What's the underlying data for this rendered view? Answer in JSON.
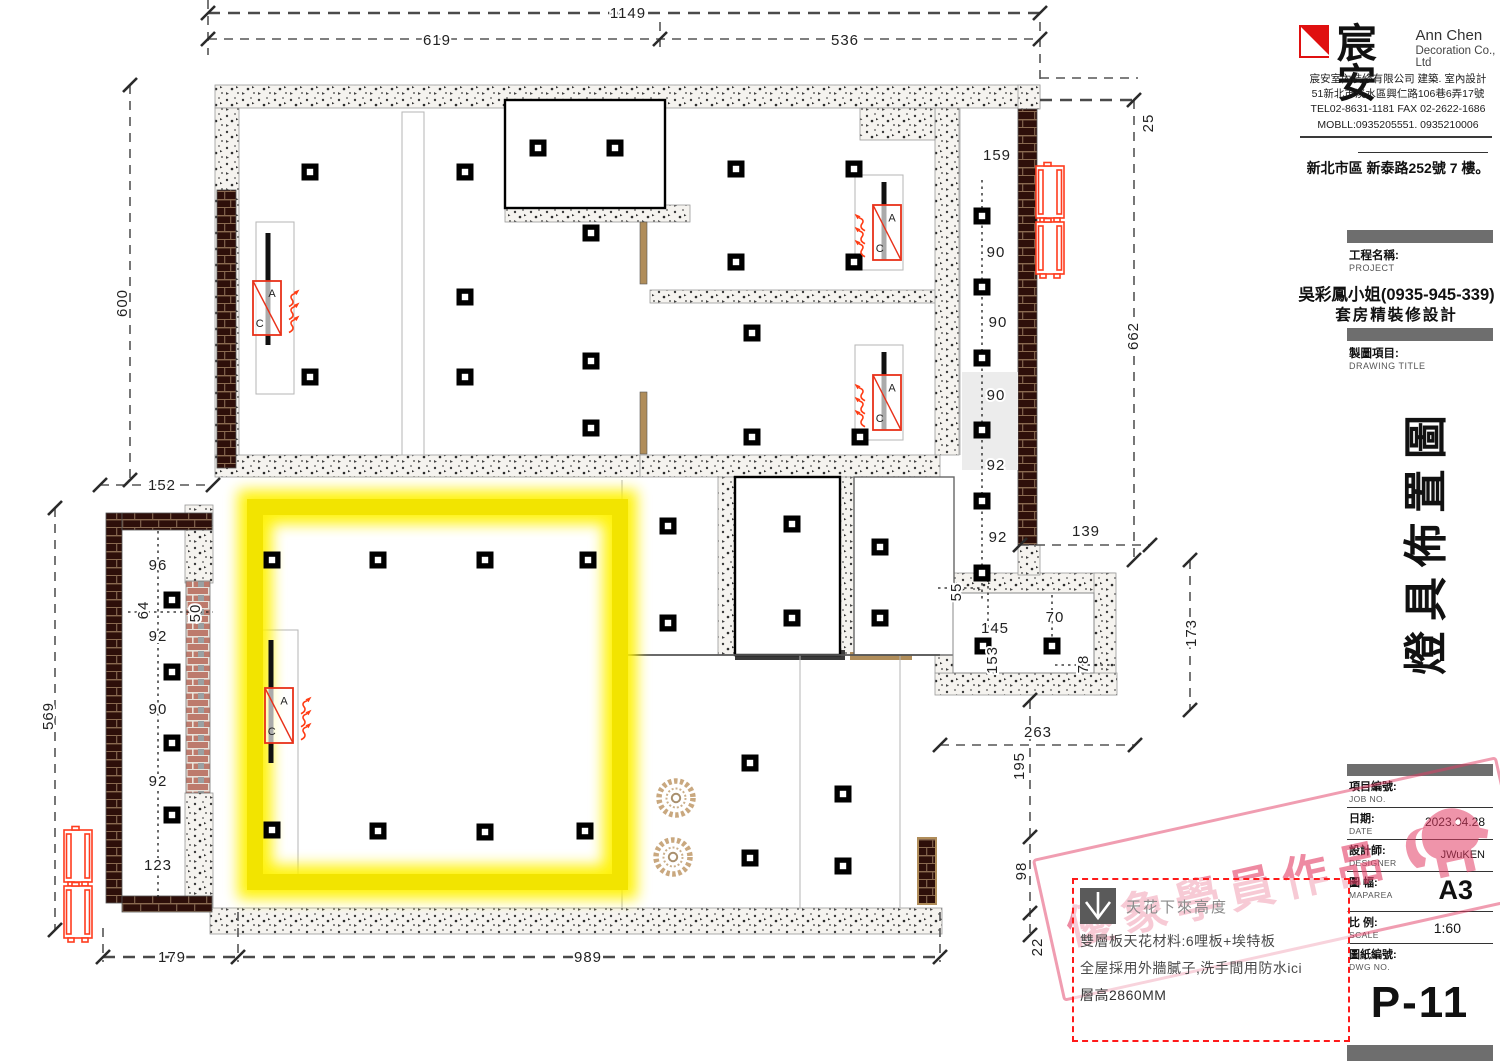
{
  "title_block": {
    "logo_cn": "宸安",
    "logo_en_line1": "Ann Chen",
    "logo_en_line2": "Decoration Co., Ltd",
    "company_line": "宸安室內裝修有限公司 建築. 室內設計",
    "company_address": "51新北市淡水區興仁路106巷6弄17號",
    "company_tel": "TEL02-8631-1181 FAX 02-2622-1686",
    "company_mobile": "MOBLL:0935205551. 0935210006",
    "site_address": "新北市區 新泰路252號 7 樓。",
    "project_label_cn": "工程名稱:",
    "project_label_en": "PROJECT",
    "client_name": "吳彩鳳小姐(0935-945-339)",
    "project_name": "套房精裝修設計",
    "drawing_label_cn": "製圖項目:",
    "drawing_label_en": "DRAWING TITLE",
    "drawing_title_vertical": "燈具佈置圖",
    "fields": {
      "job_label_cn": "項目編號:",
      "job_label_en": "JOB NO.",
      "job_value": "",
      "date_label_cn": "日期:",
      "date_label_en": "DATE",
      "date_value": "2023.04.28",
      "designer_label_cn": "設計師:",
      "designer_label_en": "DESIGNER",
      "designer_value": "JWuKEN",
      "map_label_cn": "圖 幅:",
      "map_label_en": "MAPAREA",
      "map_value": "A3",
      "scale_label_cn": "比 例:",
      "scale_label_en": "SCALE",
      "scale_value": "1:60",
      "dwg_label_cn": "圖紙編號:",
      "dwg_label_en": "DWG NO.",
      "dwg_value": "P-11"
    }
  },
  "note_box": {
    "icon_label": "天花下來高度",
    "line1": "雙層板天花材料:6哩板+埃特板",
    "line2": "全屋採用外牆膩子,洗手間用防水ici",
    "line3": "層高2860MM"
  },
  "watermark": {
    "text": "優象學員作品"
  },
  "colors": {
    "cove_yellow": "#f5e800",
    "ac_red": "#e8311a",
    "stamp_pink": "#e23c64",
    "dim_line": "#4a4a4a"
  },
  "plan": {
    "dim_labels": [
      {
        "t": "1149",
        "x": 628,
        "y": 18
      },
      {
        "t": "619",
        "x": 437,
        "y": 45
      },
      {
        "t": "536",
        "x": 845,
        "y": 45
      },
      {
        "t": "600",
        "x": 127,
        "y": 303,
        "r": 1
      },
      {
        "t": "152",
        "x": 162,
        "y": 490
      },
      {
        "t": "569",
        "x": 53,
        "y": 716,
        "r": 1
      },
      {
        "t": "179",
        "x": 172,
        "y": 962
      },
      {
        "t": "989",
        "x": 588,
        "y": 962
      },
      {
        "t": "25",
        "x": 1153,
        "y": 123,
        "r": 1
      },
      {
        "t": "662",
        "x": 1138,
        "y": 336,
        "r": 1
      },
      {
        "t": "139",
        "x": 1086,
        "y": 536
      },
      {
        "t": "173",
        "x": 1196,
        "y": 633,
        "r": 1
      },
      {
        "t": "263",
        "x": 1038,
        "y": 737
      },
      {
        "t": "195",
        "x": 1024,
        "y": 766,
        "r": 1
      },
      {
        "t": "98",
        "x": 1026,
        "y": 871,
        "r": 1
      },
      {
        "t": "22",
        "x": 1042,
        "y": 947,
        "r": 1
      },
      {
        "t": "159",
        "x": 997,
        "y": 160
      },
      {
        "t": "90",
        "x": 996,
        "y": 257
      },
      {
        "t": "90",
        "x": 998,
        "y": 327
      },
      {
        "t": "90",
        "x": 996,
        "y": 400
      },
      {
        "t": "92",
        "x": 996,
        "y": 470
      },
      {
        "t": "92",
        "x": 998,
        "y": 542
      },
      {
        "t": "55",
        "x": 961,
        "y": 592,
        "r": 1
      },
      {
        "t": "145",
        "x": 995,
        "y": 633
      },
      {
        "t": "153",
        "x": 997,
        "y": 660,
        "r": 1
      },
      {
        "t": "70",
        "x": 1055,
        "y": 622
      },
      {
        "t": "78",
        "x": 1088,
        "y": 664,
        "r": 1
      },
      {
        "t": "96",
        "x": 158,
        "y": 570
      },
      {
        "t": "64",
        "x": 148,
        "y": 610,
        "r": 1
      },
      {
        "t": "50",
        "x": 200,
        "y": 613,
        "r": 1
      },
      {
        "t": "92",
        "x": 158,
        "y": 641
      },
      {
        "t": "90",
        "x": 158,
        "y": 714
      },
      {
        "t": "92",
        "x": 158,
        "y": 786
      },
      {
        "t": "123",
        "x": 158,
        "y": 870
      }
    ],
    "lights": [
      [
        310,
        172
      ],
      [
        465,
        172
      ],
      [
        465,
        297
      ],
      [
        310,
        377
      ],
      [
        465,
        377
      ],
      [
        538,
        148
      ],
      [
        615,
        148
      ],
      [
        591,
        233
      ],
      [
        591,
        361
      ],
      [
        591,
        428
      ],
      [
        736,
        169
      ],
      [
        854,
        169
      ],
      [
        736,
        262
      ],
      [
        854,
        262
      ],
      [
        752,
        333
      ],
      [
        752,
        437
      ],
      [
        860,
        437
      ],
      [
        982,
        216
      ],
      [
        982,
        287
      ],
      [
        982,
        358
      ],
      [
        982,
        430
      ],
      [
        982,
        501
      ],
      [
        982,
        573
      ],
      [
        272,
        560
      ],
      [
        378,
        560
      ],
      [
        485,
        560
      ],
      [
        588,
        560
      ],
      [
        272,
        830
      ],
      [
        378,
        831
      ],
      [
        485,
        832
      ],
      [
        585,
        831
      ],
      [
        668,
        526
      ],
      [
        668,
        623
      ],
      [
        792,
        524
      ],
      [
        792,
        618
      ],
      [
        880,
        547
      ],
      [
        880,
        618
      ],
      [
        750,
        763
      ],
      [
        843,
        794
      ],
      [
        750,
        858
      ],
      [
        843,
        866
      ],
      [
        172,
        600
      ],
      [
        172,
        672
      ],
      [
        172,
        743
      ],
      [
        172,
        815
      ],
      [
        983,
        646
      ],
      [
        1052,
        646
      ]
    ],
    "decor_lights": [
      [
        676,
        798
      ],
      [
        673,
        857
      ]
    ],
    "ac_units": [
      {
        "x": 253,
        "y": 281,
        "w": 28,
        "h": 54,
        "bx": 15,
        "by1": -48,
        "by2": 64,
        "dir": "right",
        "label_a": "A",
        "label_c": "C"
      },
      {
        "x": 873,
        "y": 205,
        "w": 28,
        "h": 55,
        "bx": 11,
        "by1": -23,
        "by2": 55,
        "dir": "left",
        "label_a": "A",
        "label_c": "C"
      },
      {
        "x": 873,
        "y": 375,
        "w": 28,
        "h": 55,
        "bx": 11,
        "by1": -23,
        "by2": 55,
        "dir": "left",
        "label_a": "A",
        "label_c": "C"
      },
      {
        "x": 265,
        "y": 688,
        "w": 28,
        "h": 55,
        "bx": 6,
        "by1": -48,
        "by2": 75,
        "dir": "right",
        "label_a": "A",
        "label_c": "C"
      }
    ],
    "outdoor_units": [
      [
        1036,
        166
      ],
      [
        1036,
        222
      ],
      [
        64,
        830
      ],
      [
        64,
        886
      ]
    ]
  }
}
